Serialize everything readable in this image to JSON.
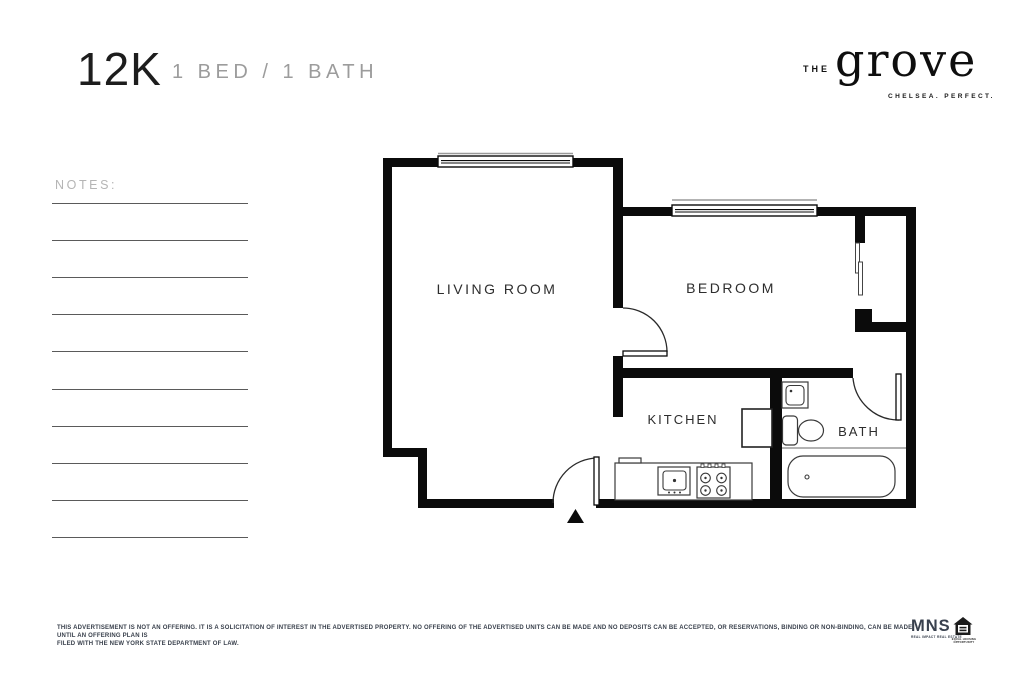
{
  "header": {
    "unit": "12K",
    "bed_bath": "1 BED / 1 BATH"
  },
  "brand": {
    "prefix": "THE",
    "name": "grove",
    "tagline": "CHELSEA. PERFECT."
  },
  "notes": {
    "label": "NOTES:"
  },
  "floorplan": {
    "living_room": "LIVING ROOM",
    "bedroom": "BEDROOM",
    "kitchen": "KITCHEN",
    "bath": "BATH"
  },
  "disclaimer": {
    "line1": "THIS ADVERTISEMENT IS NOT AN OFFERING. IT IS A SOLICITATION OF INTEREST IN THE ADVERTISED PROPERTY. NO OFFERING OF THE ADVERTISED UNITS CAN BE MADE AND NO DEPOSITS CAN BE ACCEPTED, OR RESERVATIONS, BINDING OR NON-BINDING, CAN BE MADE UNTIL AN OFFERING PLAN IS",
    "line2": "FILED WITH THE NEW YORK STATE DEPARTMENT OF LAW."
  },
  "footer": {
    "mns": "MNS",
    "mns_tagline": "REAL IMPACT REAL ESTATE",
    "equal_housing": "EQUAL HOUSING OPPORTUNITY"
  },
  "colors": {
    "ink": "#111111",
    "wall": "#0b0b0b",
    "muted_gray": "#9c9c9c",
    "notes_gray": "#b5b5b5",
    "note_line_gray": "#5a5a5a",
    "disclaimer_navy": "#39404c",
    "fixture_stroke": "#3a3a3a"
  }
}
